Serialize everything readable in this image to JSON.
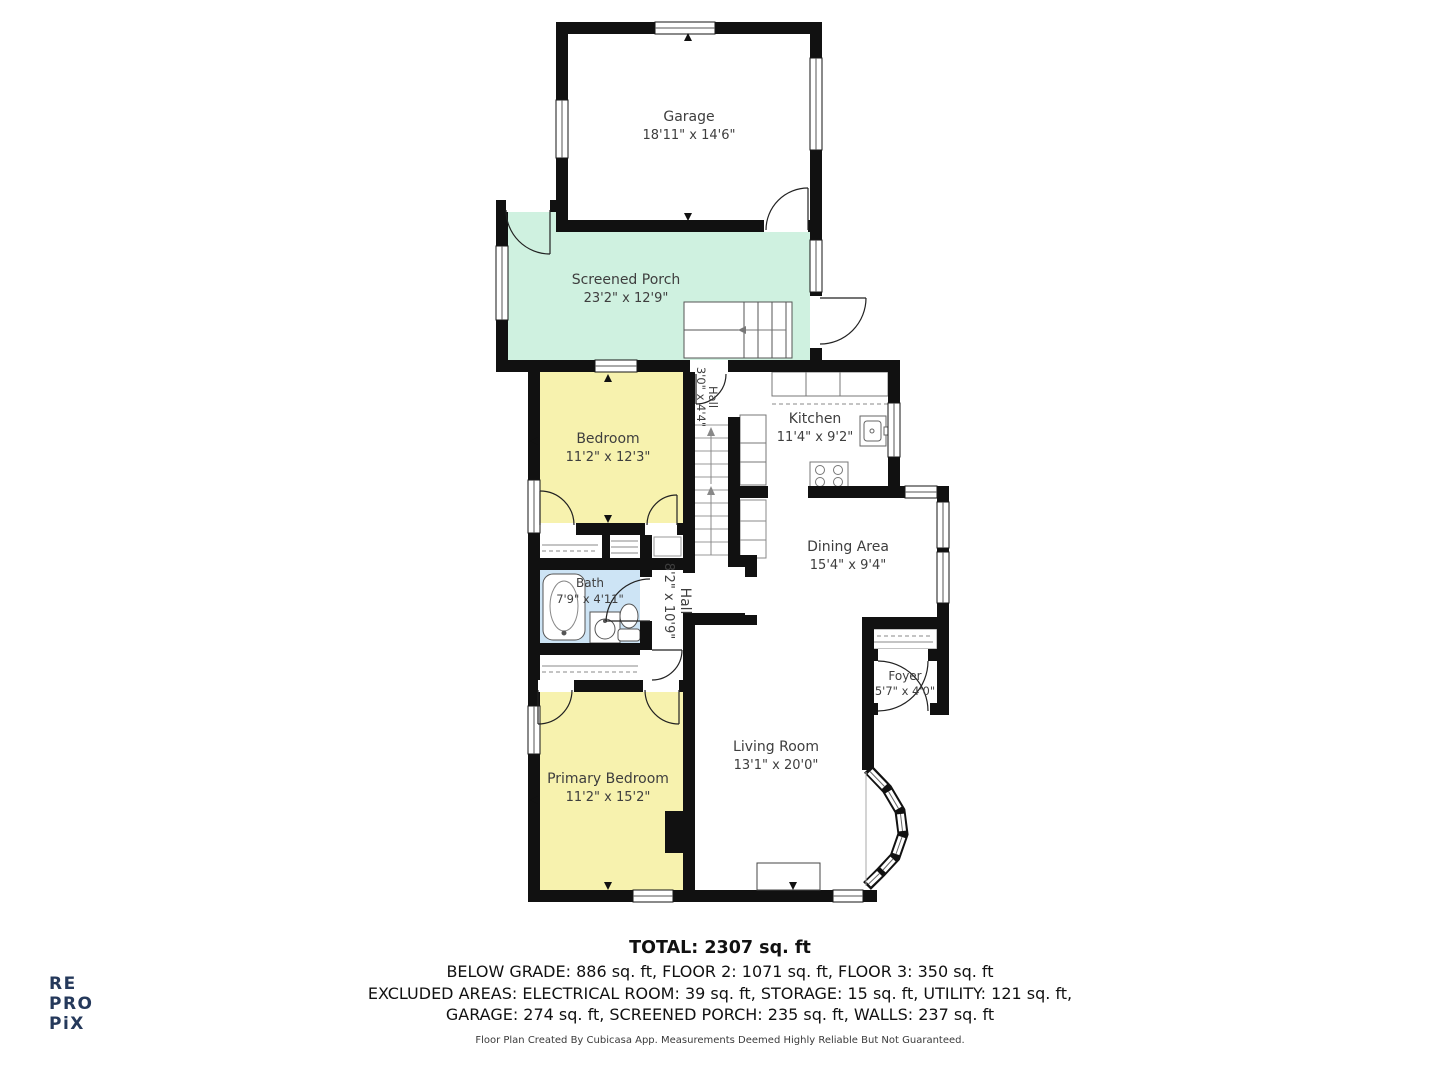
{
  "branding": {
    "logo_line1": "RE",
    "logo_line2": "PRO",
    "logo_line3": "PiX"
  },
  "rooms": {
    "garage": {
      "name": "Garage",
      "dims": "18'11\" x 14'6\""
    },
    "screened_porch": {
      "name": "Screened Porch",
      "dims": "23'2\" x 12'9\""
    },
    "hall_upper": {
      "name": "Hall",
      "dims": "3'0\" x 4'4\""
    },
    "kitchen": {
      "name": "Kitchen",
      "dims": "11'4\" x 9'2\""
    },
    "bedroom": {
      "name": "Bedroom",
      "dims": "11'2\" x 12'3\""
    },
    "dining": {
      "name": "Dining Area",
      "dims": "15'4\" x 9'4\""
    },
    "bath": {
      "name": "Bath",
      "dims": "7'9\" x 4'11\""
    },
    "hall_main": {
      "name": "Hall",
      "dims": "8'2\" x 10'9\""
    },
    "foyer": {
      "name": "Foyer",
      "dims": "5'7\" x 4'0\""
    },
    "living": {
      "name": "Living Room",
      "dims": "13'1\" x 20'0\""
    },
    "primary": {
      "name": "Primary Bedroom",
      "dims": "11'2\" x 15'2\""
    }
  },
  "summary": {
    "total": "TOTAL: 2307 sq. ft",
    "line1": "BELOW GRADE: 886 sq. ft, FLOOR 2: 1071 sq. ft, FLOOR 3: 350 sq. ft",
    "line2": "EXCLUDED AREAS: ELECTRICAL ROOM: 39 sq. ft, STORAGE: 15 sq. ft, UTILITY: 121 sq. ft,",
    "line3": "GARAGE: 274 sq. ft, SCREENED PORCH: 235 sq. ft, WALLS: 237 sq. ft",
    "disclaimer": "Floor Plan Created By Cubicasa App. Measurements Deemed Highly Reliable But Not Guaranteed."
  },
  "colors": {
    "wall": "#111111",
    "porch_fill": "#cff1e0",
    "bedroom_fill": "#f7f2ae",
    "bath_fill": "#cde4f5",
    "logo": "#25395b"
  }
}
